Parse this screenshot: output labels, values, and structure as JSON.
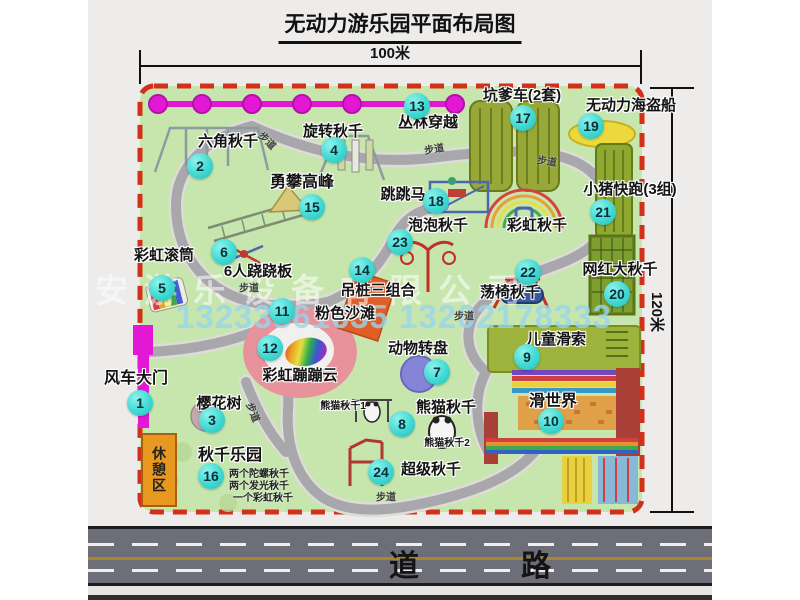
{
  "title": "无动力游乐园平面布局图",
  "dimensions": {
    "width": "100米",
    "height": "120米"
  },
  "road": {
    "label": "道　路"
  },
  "watermark": {
    "company": "安游乐设备有限公司",
    "phone": "13233861635 13202178333"
  },
  "park": {
    "walk_label": "步道",
    "rest_area_label": "休憩区",
    "rainbow_swing_label": "彩虹秋千",
    "panda_swing_1": "熊猫秋千1",
    "panda_swing_2": "熊猫秋千2",
    "swing_park_notes": [
      "两个陀螺秋千",
      "两个发光秋千",
      "一个彩虹秋千"
    ],
    "markers": [
      {
        "num": 1,
        "label": "风车大门",
        "cx": 140,
        "cy": 403,
        "lx": 136,
        "ly": 371,
        "ls": 16
      },
      {
        "num": 2,
        "label": "六角秋千",
        "cx": 200,
        "cy": 166,
        "lx": 228,
        "ly": 134,
        "ls": 15
      },
      {
        "num": 3,
        "label": "樱花树",
        "cx": 212,
        "cy": 420,
        "lx": 219,
        "ly": 396,
        "ls": 15
      },
      {
        "num": 4,
        "label": "旋转秋千",
        "cx": 334,
        "cy": 150,
        "lx": 333,
        "ly": 124,
        "ls": 15
      },
      {
        "num": 5,
        "label": "彩虹滚筒",
        "cx": 162,
        "cy": 288,
        "lx": 164,
        "ly": 248,
        "ls": 15
      },
      {
        "num": 6,
        "label": "6人跷跷板",
        "cx": 224,
        "cy": 252,
        "lx": 258,
        "ly": 264,
        "ls": 15
      },
      {
        "num": 7,
        "label": "动物转盘",
        "cx": 437,
        "cy": 372,
        "lx": 418,
        "ly": 341,
        "ls": 15
      },
      {
        "num": 8,
        "label": "熊猫秋千",
        "cx": 402,
        "cy": 424,
        "lx": 446,
        "ly": 400,
        "ls": 15
      },
      {
        "num": 9,
        "label": "儿童滑索",
        "cx": 527,
        "cy": 357,
        "lx": 556,
        "ly": 332,
        "ls": 15
      },
      {
        "num": 10,
        "label": "滑世界",
        "cx": 551,
        "cy": 421,
        "lx": 553,
        "ly": 394,
        "ls": 16
      },
      {
        "num": 11,
        "label": "粉色沙滩",
        "cx": 282,
        "cy": 311,
        "lx": 345,
        "ly": 306,
        "ls": 15
      },
      {
        "num": 12,
        "label": "彩虹蹦蹦云",
        "cx": 270,
        "cy": 348,
        "lx": 300,
        "ly": 368,
        "ls": 15
      },
      {
        "num": 13,
        "label": "丛林穿越",
        "cx": 417,
        "cy": 106,
        "lx": 428,
        "ly": 115,
        "ls": 15
      },
      {
        "num": 14,
        "label": "吊桩三组合",
        "cx": 362,
        "cy": 270,
        "lx": 378,
        "ly": 283,
        "ls": 15
      },
      {
        "num": 15,
        "label": "勇攀高峰",
        "cx": 312,
        "cy": 207,
        "lx": 302,
        "ly": 175,
        "ls": 16
      },
      {
        "num": 16,
        "label": "秋千乐园",
        "cx": 211,
        "cy": 476,
        "lx": 230,
        "ly": 448,
        "ls": 16
      },
      {
        "num": 17,
        "label": "坑爹车(2套)",
        "cx": 523,
        "cy": 118,
        "lx": 522,
        "ly": 88,
        "ls": 15
      },
      {
        "num": 18,
        "label": "跳跳马",
        "cx": 436,
        "cy": 201,
        "lx": 403,
        "ly": 187,
        "ls": 15
      },
      {
        "num": 19,
        "label": "无动力海盗船",
        "cx": 591,
        "cy": 126,
        "lx": 631,
        "ly": 98,
        "ls": 15
      },
      {
        "num": 20,
        "label": "网红大秋千",
        "cx": 617,
        "cy": 294,
        "lx": 620,
        "ly": 262,
        "ls": 15
      },
      {
        "num": 21,
        "label": "小猪快跑(3组)",
        "cx": 603,
        "cy": 212,
        "lx": 630,
        "ly": 182,
        "ls": 15
      },
      {
        "num": 22,
        "label": "荡椅秋千",
        "cx": 528,
        "cy": 272,
        "lx": 510,
        "ly": 285,
        "ls": 15
      },
      {
        "num": 23,
        "label": "泡泡秋千",
        "cx": 400,
        "cy": 242,
        "lx": 438,
        "ly": 218,
        "ls": 15
      },
      {
        "num": 24,
        "label": "超级秋千",
        "cx": 381,
        "cy": 472,
        "lx": 431,
        "ly": 462,
        "ls": 15
      }
    ],
    "walk_positions": [
      {
        "x": 268,
        "y": 140,
        "r": 45
      },
      {
        "x": 434,
        "y": 148,
        "r": -10
      },
      {
        "x": 547,
        "y": 160,
        "r": 8
      },
      {
        "x": 249,
        "y": 287,
        "r": 0
      },
      {
        "x": 254,
        "y": 412,
        "r": 68
      },
      {
        "x": 386,
        "y": 496,
        "r": 0
      },
      {
        "x": 464,
        "y": 315,
        "r": 0
      }
    ]
  }
}
